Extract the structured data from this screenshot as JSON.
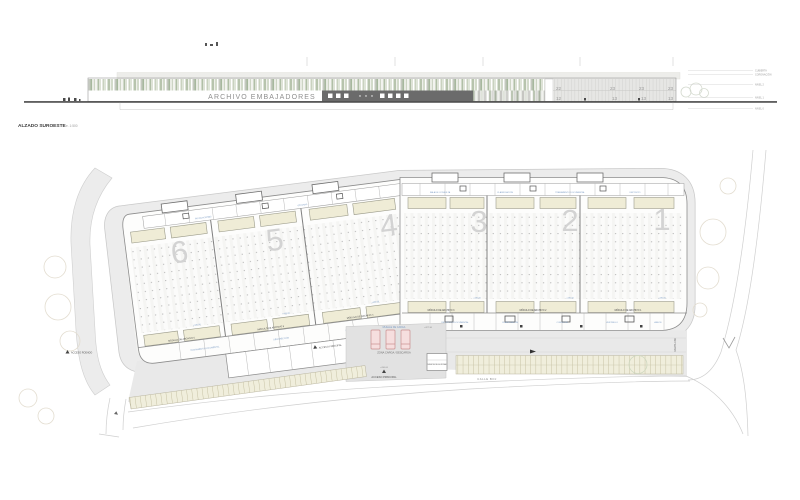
{
  "elevation": {
    "title": "ALZADO SUROESTE",
    "title_scale": "e. 1:500",
    "sign": "ARCHIVO EMBAJADORES",
    "facade_numbers_top": [
      "22",
      "23",
      "23",
      "23"
    ],
    "facade_numbers_bottom": [
      "12",
      "13",
      "13",
      "13"
    ],
    "level_labels": [
      "CUBIERTA",
      "CORONACIÓN",
      "NIVEL 2",
      "NIVEL 1",
      "NIVEL 0"
    ]
  },
  "plan": {
    "bay_numbers": [
      "6",
      "5",
      "4",
      "3",
      "2",
      "1"
    ],
    "module_labels": [
      "MÓDULO DE ARCHIVO 6",
      "MÓDULO DE ARCHIVO 5",
      "MÓDULO DE ARCHIVO 4",
      "MÓDULO DE ARCHIVO 3",
      "MÓDULO DE ARCHIVO 2",
      "MÓDULO DE ARCHIVO 1"
    ],
    "rooms_top": [
      "INSTALACIONES",
      "OFICINAS",
      "SALA DE CONSULTA",
      "CLASIFICACIÓN",
      "TRATAMIENTO DOCUMENTAL",
      "DEPÓSITO"
    ],
    "rooms_bottom": [
      "TRATAMIENTO DOCUMENTAL",
      "DESINFECCIÓN",
      "DIGITALIZACIÓN",
      "RECEPCIÓN DOCUMENTAL",
      "CLASIFICACIÓN",
      "CONSULTA",
      "VESTÍBULO",
      "ASEOS"
    ],
    "zona_carga": "ZONA CARGA / DESCARGA",
    "muelle": "MUELLE DE CARGA",
    "cota_muelle": "+427.30",
    "cota_acceso": "+430.00",
    "acceso_principal": "ACCESO PRINCIPAL",
    "acceso_personal": "ACCESO PRINCIPAL",
    "acceso_rodado": "ACCESO RODADO",
    "caseta": "CASETA SEGURIDAD",
    "calle": "CALLE BOJ",
    "rampa": "RAMPA 10%",
    "level_mark": "+430.00"
  },
  "colors": {
    "facade_dark": "#6b6b6b",
    "cream": "#efecd6",
    "blue_label": "#7c9cc4",
    "bay_number_gray": "#d3d3d3",
    "road_gray": "#ececec"
  }
}
